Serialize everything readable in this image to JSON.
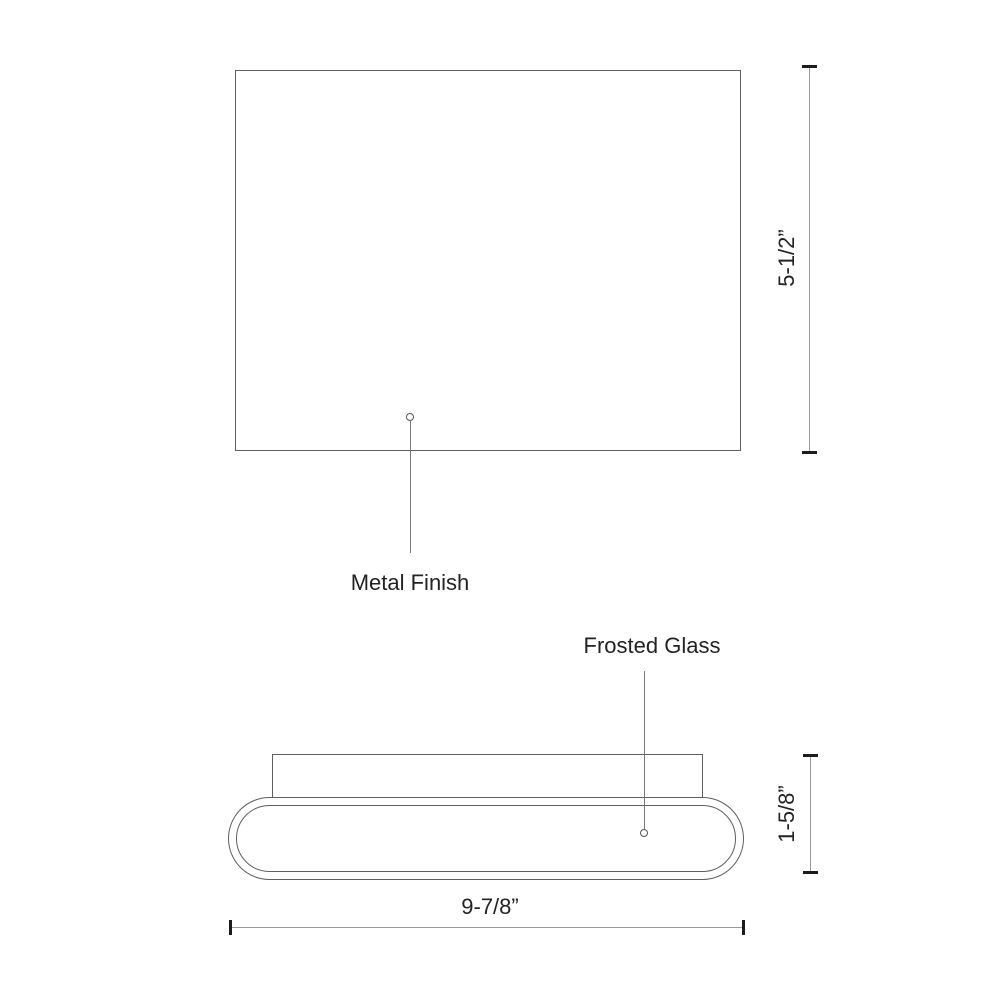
{
  "diagram": {
    "type": "technical-dimension-drawing",
    "front_view": {
      "callout_label": "Metal Finish",
      "height_dimension": "5-1/2”"
    },
    "side_view": {
      "callout_label": "Frosted Glass",
      "depth_dimension": "1-5/8”",
      "width_dimension": "9-7/8”"
    },
    "colors": {
      "background": "#ffffff",
      "outline": "#5f5f5f",
      "dimension_line": "#9a9a9a",
      "tick": "#1c1c1c",
      "text": "#232323"
    }
  }
}
